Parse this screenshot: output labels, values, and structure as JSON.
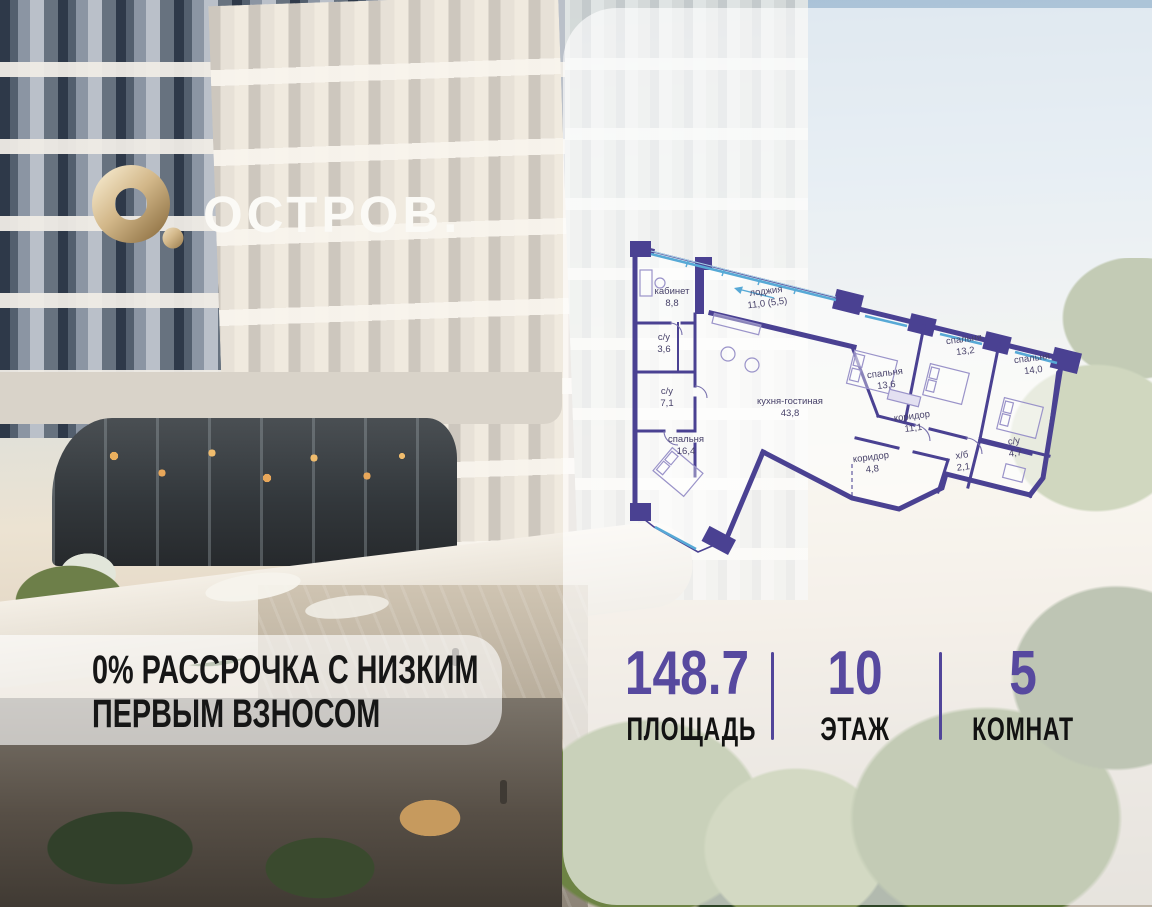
{
  "brand": {
    "wordmark": "ОСТРОВ."
  },
  "promo": {
    "line1": "0% РАССРОЧКА С НИЗКИМ",
    "line2": "ПЕРВЫМ ВЗНОСОМ"
  },
  "stats": {
    "items": [
      {
        "value": "148.7",
        "label": "ПЛОЩАДЬ"
      },
      {
        "value": "10",
        "label": "ЭТАЖ"
      },
      {
        "value": "5",
        "label": "КОМНАТ"
      }
    ]
  },
  "floorplan": {
    "rooms": [
      {
        "name": "кабинет",
        "area": "8,8"
      },
      {
        "name": "лоджия",
        "area": "11,0 (5,5)"
      },
      {
        "name": "с/у",
        "area": "3,6"
      },
      {
        "name": "с/у",
        "area": "7,1"
      },
      {
        "name": "спальня",
        "area": "16,4"
      },
      {
        "name": "кухня-гостиная",
        "area": "43,8"
      },
      {
        "name": "спальня",
        "area": "13,6"
      },
      {
        "name": "спальня",
        "area": "13,2"
      },
      {
        "name": "спальня",
        "area": "14,0"
      },
      {
        "name": "коридор",
        "area": "11,1"
      },
      {
        "name": "коридор",
        "area": "4,8"
      },
      {
        "name": "х/б",
        "area": "2,1"
      },
      {
        "name": "с/у",
        "area": "4,7"
      }
    ],
    "colors": {
      "wall": "#4a4192",
      "glazing": "#57a9d6",
      "label": "#474169"
    }
  },
  "colors": {
    "accent_purple": "#57499f",
    "gold": "#c9ab77",
    "headline": "#161616"
  }
}
